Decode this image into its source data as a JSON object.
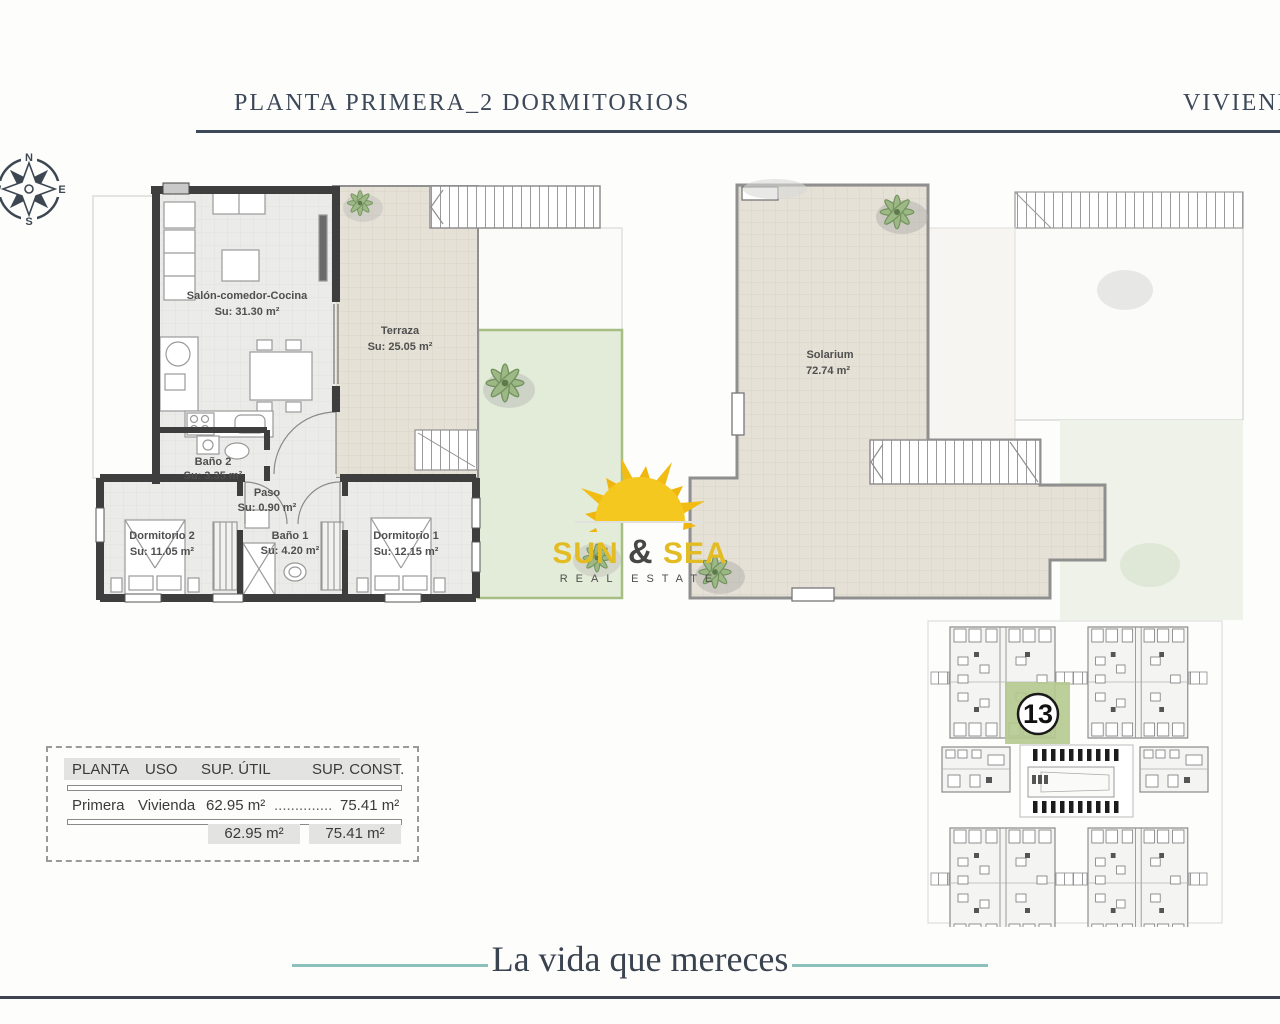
{
  "header": {
    "title_left": "PLANTA PRIMERA_2 DORMITORIOS",
    "title_right": "VIVIENDA"
  },
  "compass": {
    "north": "N",
    "east": "E",
    "south": "S",
    "west": "W"
  },
  "floor_plan": {
    "rooms": [
      {
        "name": "Salón-comedor-Cocina",
        "area": "Su: 31.30 m²"
      },
      {
        "name": "Terraza",
        "area": "Su: 25.05 m²"
      },
      {
        "name": "Baño 2",
        "area": "Su: 3.35 m²"
      },
      {
        "name": "Paso",
        "area": "Su: 0.90 m²"
      },
      {
        "name": "Dormitorio 2",
        "area": "Su: 11.05 m²"
      },
      {
        "name": "Baño 1",
        "area": "Su: 4.20 m²"
      },
      {
        "name": "Dormitorio 1",
        "area": "Su: 12.15 m²"
      }
    ]
  },
  "solarium_plan": {
    "name": "Solarium",
    "area": "72.74 m²"
  },
  "logo": {
    "word1": "SUN",
    "ampersand": "&",
    "word2": "SEA",
    "subtitle": "REAL ESTATE"
  },
  "summary_table": {
    "headers": [
      "PLANTA",
      "USO",
      "SUP. ÚTIL",
      "SUP. CONST."
    ],
    "rows": [
      {
        "planta": "Primera",
        "uso": "Vivienda",
        "sup_util": "62.95 m²",
        "dots": "..............",
        "sup_const": "75.41 m²"
      }
    ],
    "totals": {
      "sup_util": "62.95 m²",
      "sup_const": "75.41 m²"
    }
  },
  "site_plan": {
    "highlighted_unit": "13"
  },
  "footer": {
    "tagline": "La vida que mereces"
  },
  "colors": {
    "accent_navy": "#3d4858",
    "teal": "#8cc0bb",
    "wall": "#3e3e3e",
    "terrace_beige": "#e6e1d6",
    "garden_green": "#e3ecd8",
    "highlight_green": "#b5c98e",
    "logo_yellow": "#e2bc22"
  }
}
